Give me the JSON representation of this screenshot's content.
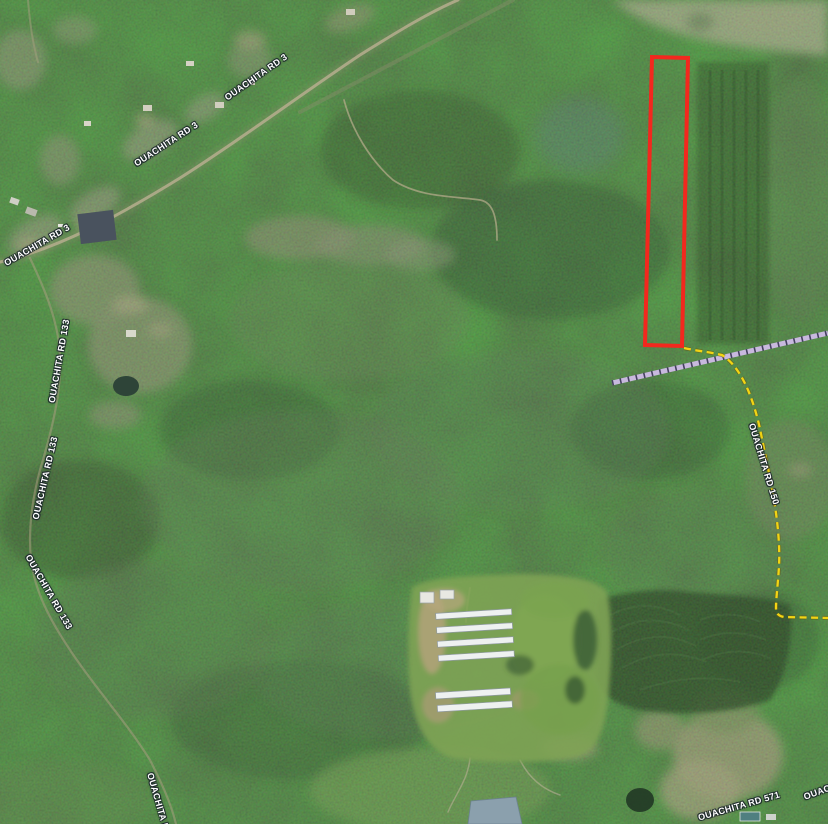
{
  "map": {
    "road_labels": {
      "rd3_a": "OUACHITA RD 3",
      "rd3_b": "OUACHITA RD 3",
      "rd3_c": "OUACHITA RD 3",
      "rd133_a": "OUACHITA RD 133",
      "rd133_b": "OUACHITA RD 133",
      "rd133_c": "OUACHITA RD 133",
      "rd133_d": "OUACHITA RD 133",
      "rd150": "OUACHITA RD 150",
      "rd571_a": "OUACHITA RD 571",
      "rd571_b": "OUACHITA RD 571"
    },
    "colors": {
      "parcel_outline": "#f2281e",
      "road150_dash": "#f2d414",
      "utility_band": "#c8b9de",
      "utility_ticks": "#45415f",
      "label_text": "#ffffff",
      "forest_base": "#314a2b"
    }
  }
}
